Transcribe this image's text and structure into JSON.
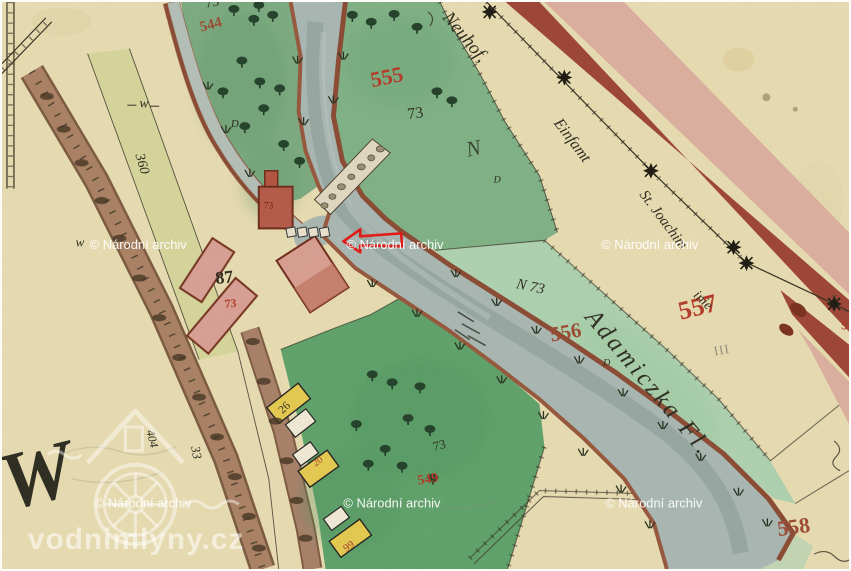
{
  "watermarks": {
    "archive": "© Národní archiv",
    "site": "vodnimlyny.cz"
  },
  "annotations": {
    "arrow_color": "#e01b17"
  },
  "parcel_numbers": {
    "n544": "544",
    "n555": "555",
    "n556": "556",
    "n557": "557",
    "n558": "558",
    "n549": "549",
    "roman_iii": "III"
  },
  "plot_marks": {
    "p73_top_edge": "73",
    "p73_meadow": "73",
    "p73_orchard": "73",
    "n73_river": "N 73",
    "p73_farm": "73",
    "p73_mill": "73"
  },
  "house_numbers": {
    "h87": "87",
    "h26": "26",
    "h20": "20",
    "h99": "99"
  },
  "handwriting": {
    "road_1": "Neuhof,",
    "road_2": "Einfamt",
    "road_3": "St. Joachim",
    "road_4": "inie",
    "river_name": "Adamiczka Fl.",
    "letter_n": "N",
    "letter_d1": "D",
    "letter_d2": "D",
    "letter_d3": "D",
    "meadow_w1": "w",
    "meadow_w2": "w",
    "num_360": "360",
    "num_33": "33",
    "num_404": "404",
    "big_w": "W",
    "mark_x": "x",
    "num_5": "5"
  },
  "palette": {
    "parchment": "#e8dcb2",
    "meadow_green": "#7cab81",
    "light_green": "#aed2b0",
    "river_gray": "#a9b7b3",
    "road_pink": "#dcaf9f",
    "road_dark_red": "#9d4436",
    "building_pink": "#d9a096",
    "ink": "#2b2b20",
    "red_number": "#b43a28"
  }
}
